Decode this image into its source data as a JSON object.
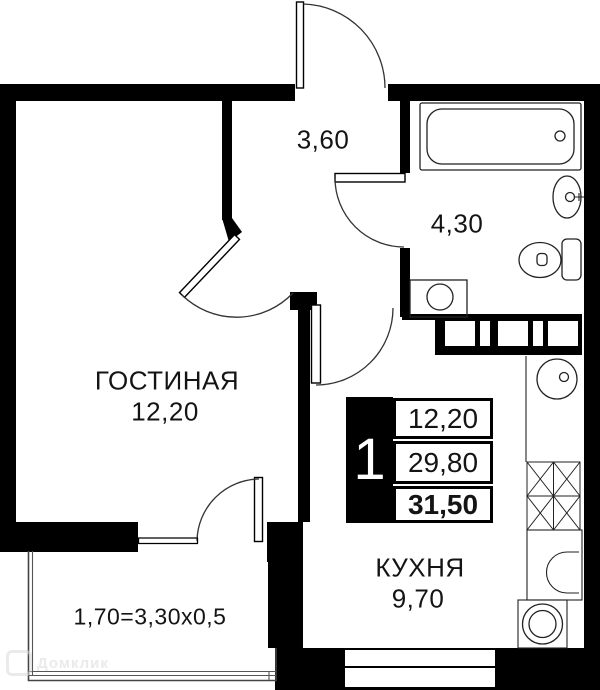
{
  "rooms": {
    "hallway": {
      "area": "3,60"
    },
    "bathroom": {
      "area": "4,30"
    },
    "living": {
      "name": "ГОСТИНАЯ",
      "area": "12,20"
    },
    "kitchen": {
      "name": "КУХНЯ",
      "area": "9,70"
    },
    "balcony": {
      "area": "1,70=3,30x0,5"
    }
  },
  "info_box": {
    "room_count": "1",
    "living_area": "12,20",
    "apartment_area": "29,80",
    "total_area": "31,50"
  },
  "watermark": "Домклик",
  "colors": {
    "wall": "#000000",
    "background": "#ffffff",
    "fixture_line": "#222222",
    "watermark": "#d9d9d9"
  }
}
